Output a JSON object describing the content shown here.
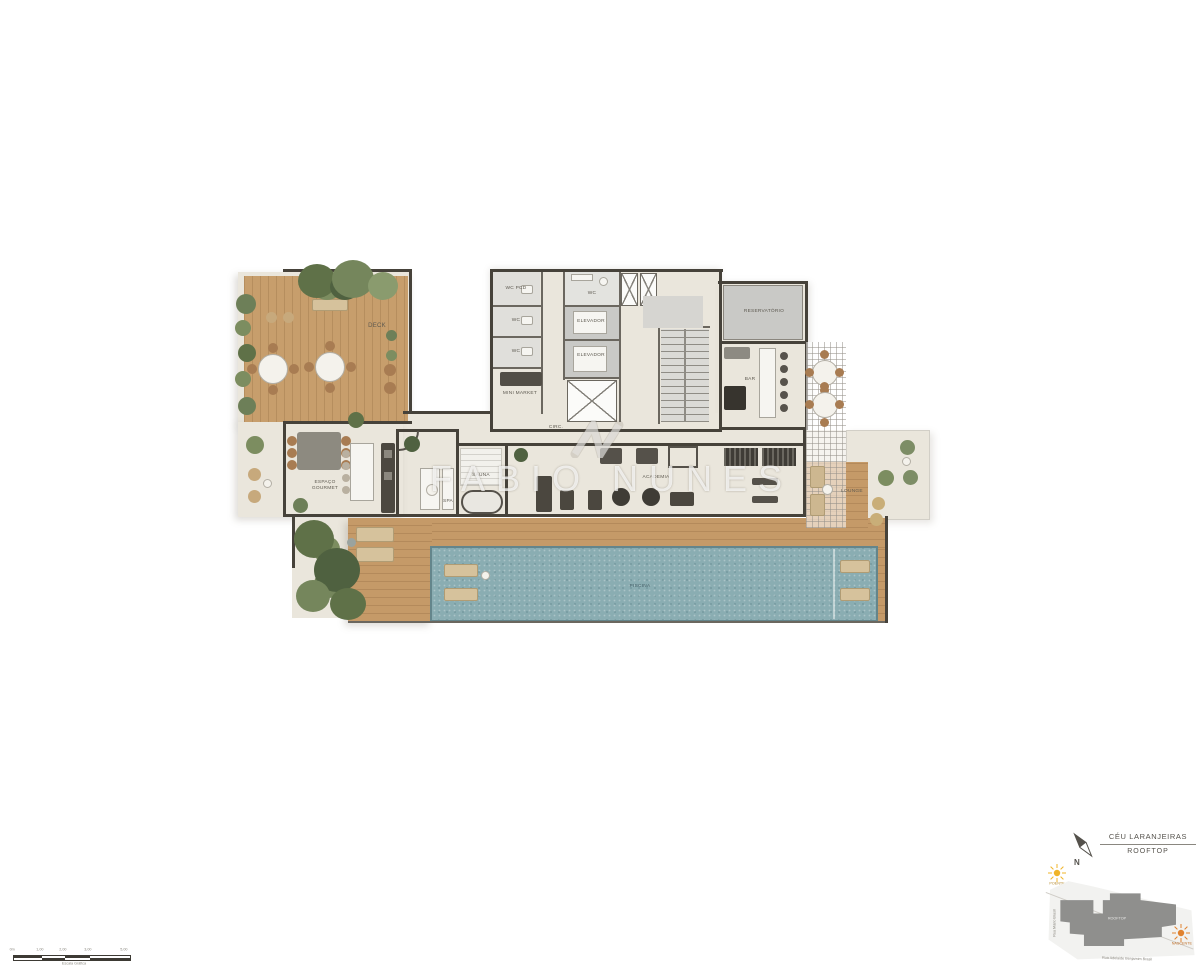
{
  "watermark": {
    "brand": "FABIO NUNES"
  },
  "plan": {
    "labels": {
      "deck": "DECK",
      "wc_pcd": "WC PCD",
      "wc": "WC",
      "mini_market": "MINI MARKET",
      "elevador": "ELEVADOR",
      "reservatorio": "RESERVATÓRIO",
      "bar": "BAR",
      "circ": "CIRC.",
      "espaco_gourmet": "ESPAÇO GOURMET",
      "spa": "SPA",
      "sauna": "SAUNA",
      "academia": "ACADEMIA",
      "lounge": "LOUNGE",
      "piscina": "PISCINA"
    }
  },
  "legend": {
    "project_name": "CÉU LARANJEIRAS",
    "floor_name": "ROOFTOP",
    "compass_north": "N",
    "site_building_label": "ROOFTOP",
    "street_left": "Rua Mário Brasil",
    "street_bottom": "Rua Adelaide Benjamim Brasil",
    "sun_top": "POENTE",
    "sun_bottom": "NASCENTE"
  },
  "scale_bar": {
    "ticks": [
      "0m",
      "1,00",
      "2,00",
      "3,00",
      "5,00"
    ],
    "caption": "Escala Gráfica"
  },
  "colors": {
    "floor": "#eae6dc",
    "wood": "#c59a68",
    "wall": "#46423a",
    "pool": "#8aadb2",
    "plant": "#6d7f58",
    "sun_yellow": "#f0b429",
    "sun_orange": "#e0812e"
  }
}
